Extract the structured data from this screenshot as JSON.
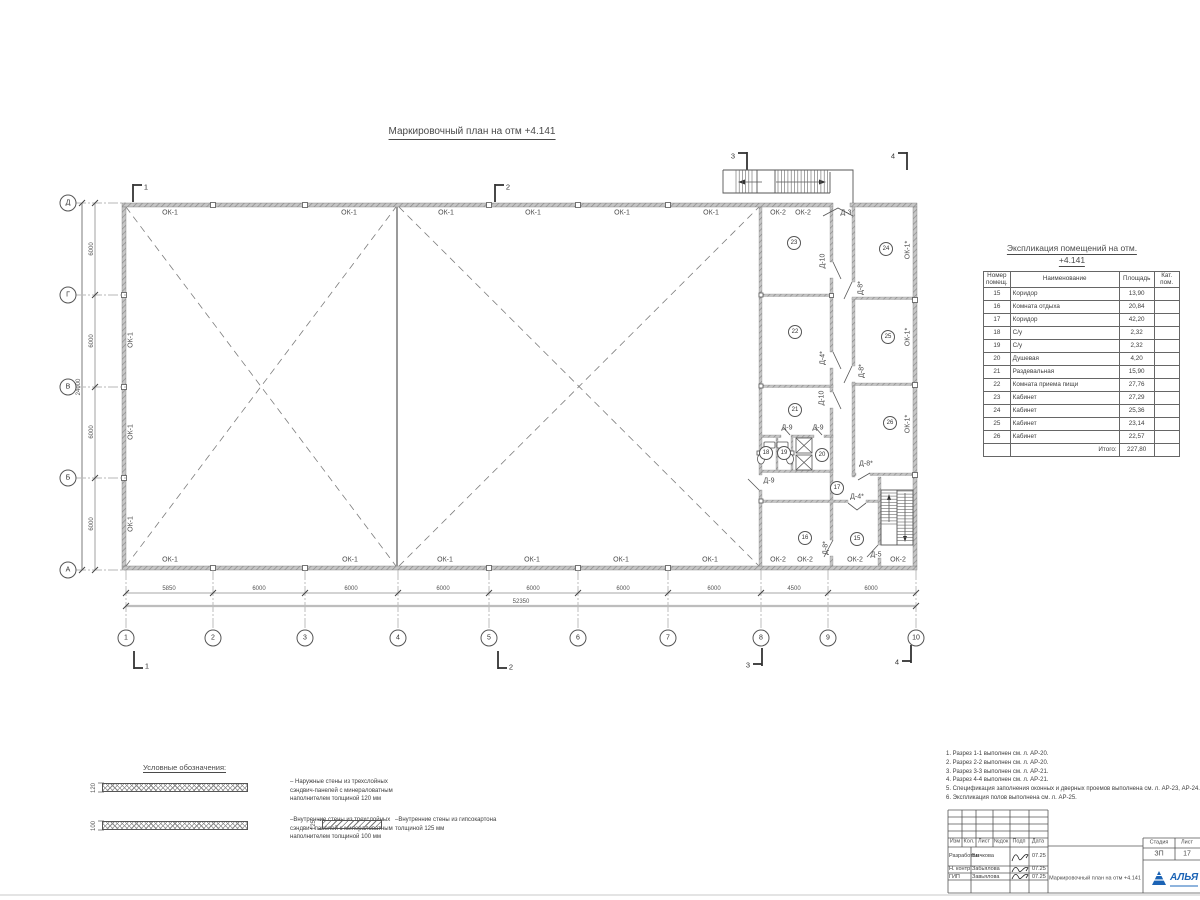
{
  "page": {
    "title": "Маркировочный план на отм +4.141"
  },
  "plan": {
    "grid_cols": [
      {
        "t": "1",
        "x": 126
      },
      {
        "t": "2",
        "x": 213
      },
      {
        "t": "3",
        "x": 305
      },
      {
        "t": "4",
        "x": 398
      },
      {
        "t": "5",
        "x": 489
      },
      {
        "t": "6",
        "x": 578
      },
      {
        "t": "7",
        "x": 668
      },
      {
        "t": "8",
        "x": 761
      },
      {
        "t": "9",
        "x": 828
      },
      {
        "t": "10",
        "x": 916
      }
    ],
    "grid_rows": [
      {
        "t": "А",
        "y": 570
      },
      {
        "t": "Б",
        "y": 478
      },
      {
        "t": "В",
        "y": 387
      },
      {
        "t": "Г",
        "y": 295
      },
      {
        "t": "Д",
        "y": 203
      }
    ],
    "rooms": [
      {
        "t": "15",
        "x": 857,
        "y": 539
      },
      {
        "t": "16",
        "x": 805,
        "y": 538
      },
      {
        "t": "17",
        "x": 837,
        "y": 488
      },
      {
        "t": "18",
        "x": 766,
        "y": 453
      },
      {
        "t": "19",
        "x": 784,
        "y": 453
      },
      {
        "t": "20",
        "x": 822,
        "y": 455
      },
      {
        "t": "21",
        "x": 795,
        "y": 410
      },
      {
        "t": "22",
        "x": 795,
        "y": 332
      },
      {
        "t": "23",
        "x": 794,
        "y": 243
      },
      {
        "t": "24",
        "x": 886,
        "y": 249
      },
      {
        "t": "25",
        "x": 888,
        "y": 337
      },
      {
        "t": "26",
        "x": 890,
        "y": 423
      }
    ],
    "labels": [
      {
        "t": "ОК-1",
        "x": 170,
        "y": 213,
        "n": "window-label"
      },
      {
        "t": "ОК-1",
        "x": 349,
        "y": 213,
        "n": "window-label"
      },
      {
        "t": "ОК-1",
        "x": 446,
        "y": 213,
        "n": "window-label"
      },
      {
        "t": "ОК-1",
        "x": 533,
        "y": 213,
        "n": "window-label"
      },
      {
        "t": "ОК-1",
        "x": 622,
        "y": 213,
        "n": "window-label"
      },
      {
        "t": "ОК-1",
        "x": 711,
        "y": 213,
        "n": "window-label"
      },
      {
        "t": "ОК-2",
        "x": 778,
        "y": 213,
        "n": "window-label"
      },
      {
        "t": "ОК-2",
        "x": 803,
        "y": 213,
        "n": "window-label"
      },
      {
        "t": "Д-3",
        "x": 846,
        "y": 213,
        "n": "door-label"
      },
      {
        "t": "ОК-1",
        "x": 170,
        "y": 560,
        "n": "window-label"
      },
      {
        "t": "ОК-1",
        "x": 350,
        "y": 560,
        "n": "window-label"
      },
      {
        "t": "ОК-1",
        "x": 445,
        "y": 560,
        "n": "window-label"
      },
      {
        "t": "ОК-1",
        "x": 532,
        "y": 560,
        "n": "window-label"
      },
      {
        "t": "ОК-1",
        "x": 621,
        "y": 560,
        "n": "window-label"
      },
      {
        "t": "ОК-1",
        "x": 710,
        "y": 560,
        "n": "window-label"
      },
      {
        "t": "ОК-2",
        "x": 778,
        "y": 560,
        "n": "window-label"
      },
      {
        "t": "ОК-2",
        "x": 805,
        "y": 560,
        "n": "window-label"
      },
      {
        "t": "ОК-2",
        "x": 855,
        "y": 560,
        "n": "window-label"
      },
      {
        "t": "ОК-2",
        "x": 898,
        "y": 560,
        "n": "window-label"
      },
      {
        "t": "ОК-1",
        "x": 131,
        "y": 340,
        "r": 1,
        "n": "window-label"
      },
      {
        "t": "ОК-1",
        "x": 131,
        "y": 432,
        "r": 1,
        "n": "window-label"
      },
      {
        "t": "ОК-1",
        "x": 131,
        "y": 524,
        "r": 1,
        "n": "window-label"
      },
      {
        "t": "ОК-1*",
        "x": 908,
        "y": 250,
        "r": 1,
        "n": "window-label"
      },
      {
        "t": "ОК-1*",
        "x": 908,
        "y": 337,
        "r": 1,
        "n": "window-label"
      },
      {
        "t": "ОК-1*",
        "x": 908,
        "y": 424,
        "r": 1,
        "n": "window-label"
      },
      {
        "t": "Д-10",
        "x": 823,
        "y": 261,
        "r": 1,
        "n": "door-label"
      },
      {
        "t": "Д-8*",
        "x": 861,
        "y": 288,
        "r": 1,
        "n": "door-label"
      },
      {
        "t": "Д-4*",
        "x": 823,
        "y": 358,
        "r": 1,
        "n": "door-label"
      },
      {
        "t": "Д-8*",
        "x": 862,
        "y": 371,
        "r": 1,
        "n": "door-label"
      },
      {
        "t": "Д-10",
        "x": 822,
        "y": 398,
        "r": 1,
        "n": "door-label"
      },
      {
        "t": "Д-9",
        "x": 787,
        "y": 428,
        "n": "door-label"
      },
      {
        "t": "Д-9",
        "x": 818,
        "y": 428,
        "n": "door-label"
      },
      {
        "t": "Д-8*",
        "x": 866,
        "y": 464,
        "n": "door-label"
      },
      {
        "t": "Д-9",
        "x": 769,
        "y": 481,
        "n": "door-label"
      },
      {
        "t": "Д-4*",
        "x": 857,
        "y": 497,
        "n": "door-label"
      },
      {
        "t": "Д-8*",
        "x": 826,
        "y": 548,
        "r": 1,
        "n": "door-label"
      },
      {
        "t": "Д-5",
        "x": 876,
        "y": 555,
        "n": "door-label"
      },
      {
        "t": "1",
        "x": 146,
        "y": 187,
        "c": "sec",
        "n": "section-mark-label"
      },
      {
        "t": "2",
        "x": 508,
        "y": 187,
        "c": "sec",
        "n": "section-mark-label"
      },
      {
        "t": "3",
        "x": 733,
        "y": 156,
        "c": "sec",
        "n": "section-mark-label"
      },
      {
        "t": "4",
        "x": 893,
        "y": 156,
        "c": "sec",
        "n": "section-mark-label"
      },
      {
        "t": "1",
        "x": 147,
        "y": 666,
        "c": "sec",
        "n": "section-mark-label"
      },
      {
        "t": "2",
        "x": 511,
        "y": 667,
        "c": "sec",
        "n": "section-mark-label"
      },
      {
        "t": "3",
        "x": 748,
        "y": 665,
        "c": "sec",
        "n": "section-mark-label"
      },
      {
        "t": "4",
        "x": 897,
        "y": 662,
        "c": "sec",
        "n": "section-mark-label"
      },
      {
        "t": "5850",
        "x": 169,
        "y": 589,
        "c": "dim",
        "n": "dimension-label"
      },
      {
        "t": "6000",
        "x": 259,
        "y": 589,
        "c": "dim",
        "n": "dimension-label"
      },
      {
        "t": "6000",
        "x": 351,
        "y": 589,
        "c": "dim",
        "n": "dimension-label"
      },
      {
        "t": "6000",
        "x": 443,
        "y": 589,
        "c": "dim",
        "n": "dimension-label"
      },
      {
        "t": "6000",
        "x": 533,
        "y": 589,
        "c": "dim",
        "n": "dimension-label"
      },
      {
        "t": "6000",
        "x": 623,
        "y": 589,
        "c": "dim",
        "n": "dimension-label"
      },
      {
        "t": "6000",
        "x": 714,
        "y": 589,
        "c": "dim",
        "n": "dimension-label"
      },
      {
        "t": "4500",
        "x": 794,
        "y": 589,
        "c": "dim",
        "n": "dimension-label"
      },
      {
        "t": "6000",
        "x": 871,
        "y": 589,
        "c": "dim",
        "n": "dimension-label"
      },
      {
        "t": "52350",
        "x": 521,
        "y": 602,
        "c": "dim",
        "n": "dimension-label"
      },
      {
        "t": "6000",
        "x": 92,
        "y": 249,
        "r": 1,
        "c": "dim",
        "n": "dimension-label"
      },
      {
        "t": "6000",
        "x": 92,
        "y": 341,
        "r": 1,
        "c": "dim",
        "n": "dimension-label"
      },
      {
        "t": "6000",
        "x": 92,
        "y": 432,
        "r": 1,
        "c": "dim",
        "n": "dimension-label"
      },
      {
        "t": "6000",
        "x": 92,
        "y": 524,
        "r": 1,
        "c": "dim",
        "n": "dimension-label"
      },
      {
        "t": "24000",
        "x": 79,
        "y": 387,
        "r": 1,
        "c": "dim",
        "n": "dimension-label"
      }
    ]
  },
  "schedule": {
    "title1": "Экспликация помещений на отм.",
    "title2": "+4.141",
    "headers": [
      "Номер помещ.",
      "Наименование",
      "Площадь",
      "Кат. пом."
    ],
    "rows": [
      {
        "num": "15",
        "name": "Коридор",
        "area": "13,90"
      },
      {
        "num": "16",
        "name": "Комната отдыха",
        "area": "20,84"
      },
      {
        "num": "17",
        "name": "Коридор",
        "area": "42,20"
      },
      {
        "num": "18",
        "name": "С/у",
        "area": "2,32"
      },
      {
        "num": "19",
        "name": "С/у",
        "area": "2,32"
      },
      {
        "num": "20",
        "name": "Душевая",
        "area": "4,20"
      },
      {
        "num": "21",
        "name": "Раздевальная",
        "area": "15,90"
      },
      {
        "num": "22",
        "name": "Комната приема пищи",
        "area": "27,76"
      },
      {
        "num": "23",
        "name": "Кабинет",
        "area": "27,29"
      },
      {
        "num": "24",
        "name": "Кабинет",
        "area": "25,36"
      },
      {
        "num": "25",
        "name": "Кабинет",
        "area": "23,14"
      },
      {
        "num": "26",
        "name": "Кабинет",
        "area": "22,57"
      }
    ],
    "total_label": "Итого:",
    "total_value": "227,80"
  },
  "legend": {
    "title": "Условные обозначения:",
    "items": [
      {
        "thick": "120",
        "bx": 102,
        "by": 783,
        "bw": 146,
        "style": "cross",
        "tx": 290,
        "ty": 779,
        "lines": [
          "– Наружные стены из трехслойных",
          "сэндвич-панелей с минераловатным",
          "наполнителем толщиной 120 мм"
        ]
      },
      {
        "thick": "100",
        "bx": 102,
        "by": 821,
        "bw": 146,
        "style": "cross",
        "tx": 290,
        "ty": 817,
        "lines": [
          "–Внутренние стены из трехслойных",
          "сэндвич-панелей с минераловатным",
          "наполнителем толщиной 100 мм"
        ]
      },
      {
        "thick": "125",
        "bx": 322,
        "by": 820,
        "bw": 60,
        "style": "diag",
        "tx": 395,
        "ty": 817,
        "lines": [
          "–Внутренние стены из гипсокартона",
          "толщиной 125 мм"
        ]
      }
    ]
  },
  "notes": [
    "1. Разрез 1-1 выполнен см. л. АР-20.",
    "2. Разрез 2-2 выполнен см. л. АР-20.",
    "3. Разрез 3-3 выполнен см. л. АР-21.",
    "4. Разрез 4-4 выполнен см. л. АР-21.",
    "5. Спецификация заполнения оконных и дверных проемов выполнена см. л. АР-23, АР-24.",
    "6. Экспликация полов выполнена см. л. АР-25."
  ],
  "titleblock": {
    "col_izm": "Изм",
    "col_kol": "Кол.",
    "col_list": "Лист",
    "col_ndok": "№док",
    "col_podp": "Подп",
    "col_data": "Дата",
    "sign_rows": [
      {
        "role": "Разработал",
        "name": "Бычкова",
        "date": "07.25"
      },
      {
        "role": "Н. контр",
        "name": "Забьялова",
        "date": "07.25"
      },
      {
        "role": "ГИП",
        "name": "Завьялова",
        "date": "07.25"
      }
    ],
    "doc_title": "Маркировочный план на отм +4.141",
    "stage_label": "Стадия",
    "sheet_label": "Лист",
    "stage_value": "ЗП",
    "sheet_value": "17",
    "logo_text": "АЛЬЯ",
    "logo_color": "#1b63b5"
  }
}
